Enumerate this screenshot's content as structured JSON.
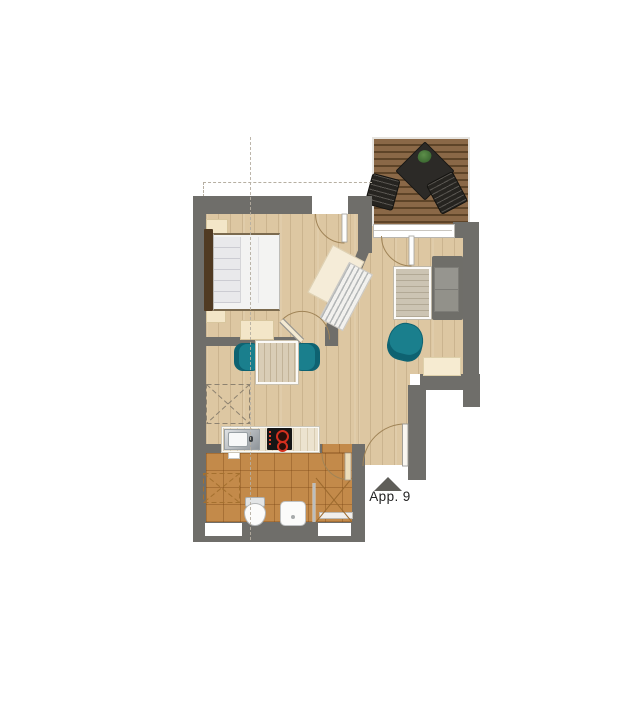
{
  "labels": {
    "entrance": "App. 9"
  },
  "colors": {
    "wall": "#6f6e6a",
    "floor": "#ddc7a2",
    "tile": "#c38a4a",
    "teal": "#1a7f8d",
    "tealdark": "#0e6271",
    "cream": "#f3e6c8",
    "deckA": "#8a6847",
    "deckB": "#5e4428",
    "sofa": "#6f6e69",
    "cushion": "#96958f",
    "table": "#ccc4b3",
    "red": "#d4301f",
    "text": "#232323",
    "arrow": "#5f5e59",
    "guide": "#b6afa2",
    "doorarc": "#a08457"
  },
  "legend": {
    "rooms": [
      "bedroom",
      "living-area",
      "dining-area",
      "kitchen",
      "bathroom",
      "hall",
      "terrace"
    ],
    "furniture": [
      "double-bed",
      "nightstand",
      "dresser",
      "dining-table",
      "dining-chair",
      "kitchen-counter",
      "sink",
      "cooktop",
      "sofa",
      "coffee-table",
      "armchair",
      "sideboard",
      "toilet",
      "washbasin",
      "shower",
      "terrace-table",
      "terrace-chair",
      "plant"
    ]
  }
}
